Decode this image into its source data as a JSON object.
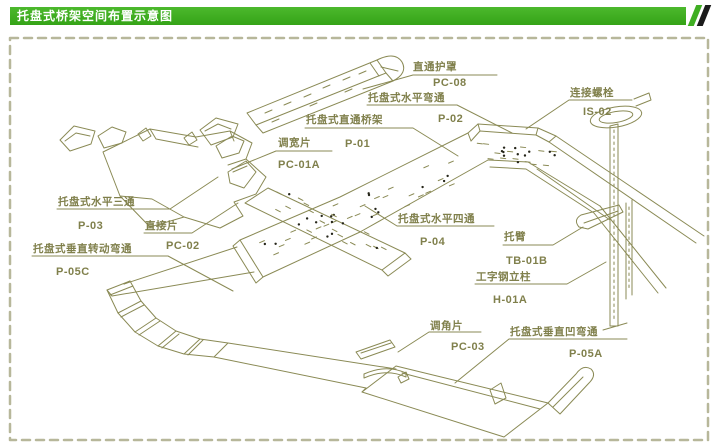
{
  "header": {
    "title": "托盘式桥架空间布置示意图"
  },
  "colors": {
    "accent_green": "#3fae22",
    "line_olive": "#8a8a55",
    "label_olive": "#80804c",
    "frame_dash": "#b7b79a",
    "perforation_dot": "#26261a",
    "background": "#ffffff"
  },
  "parts": [
    {
      "id": "pc08",
      "name": "直通护罩",
      "code": "PC-08"
    },
    {
      "id": "p02",
      "name": "托盘式水平弯通",
      "code": "P-02"
    },
    {
      "id": "p01",
      "name": "托盘式直通桥架",
      "code": "P-01"
    },
    {
      "id": "is02",
      "name": "连接螺栓",
      "code": "IS-02"
    },
    {
      "id": "pc01a",
      "name": "调宽片",
      "code": "PC-01A"
    },
    {
      "id": "p03",
      "name": "托盘式水平三通",
      "code": "P-03"
    },
    {
      "id": "pc02",
      "name": "直接片",
      "code": "PC-02"
    },
    {
      "id": "p05c",
      "name": "托盘式垂直转动弯通",
      "code": "P-05C"
    },
    {
      "id": "p04",
      "name": "托盘式水平四通",
      "code": "P-04"
    },
    {
      "id": "tb01b",
      "name": "托臂",
      "code": "TB-01B"
    },
    {
      "id": "h01a",
      "name": "工字钢立柱",
      "code": "H-01A"
    },
    {
      "id": "pc03",
      "name": "调角片",
      "code": "PC-03"
    },
    {
      "id": "p05a",
      "name": "托盘式垂直凹弯通",
      "code": "P-05A"
    }
  ]
}
